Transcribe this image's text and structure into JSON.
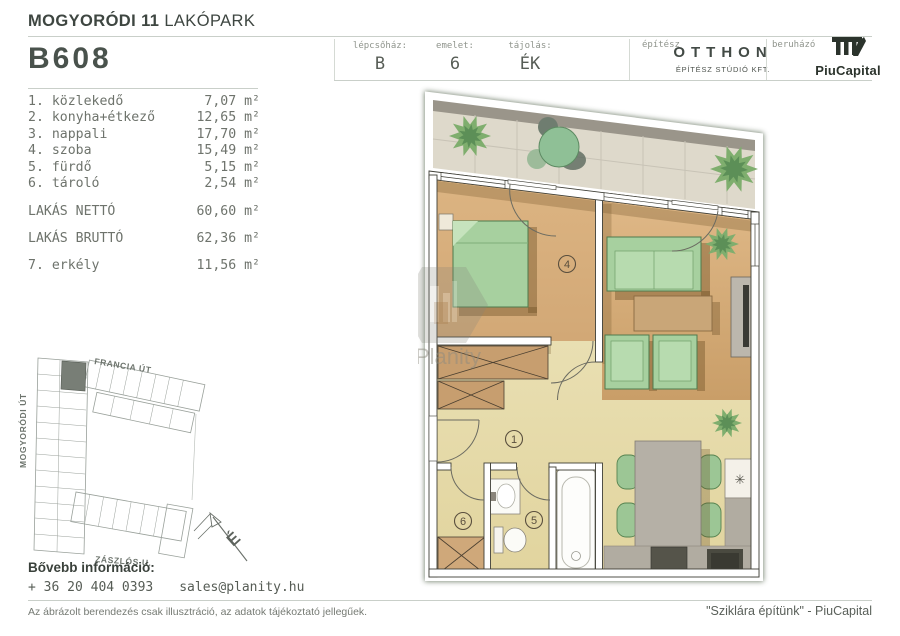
{
  "header": {
    "project_bold": "MOGYORÓDI 11",
    "project_light": " LAKÓPARK",
    "unit_id": "B608",
    "meta": [
      {
        "label": "lépcsőház:",
        "value": "B"
      },
      {
        "label": "emelet:",
        "value": "6"
      },
      {
        "label": "tájolás:",
        "value": "ÉK"
      }
    ],
    "architect": {
      "label": "építész",
      "name": "OTTHON",
      "sub": "ÉPÍTÉSZ STÚDIÓ KFT."
    },
    "developer": {
      "label": "beruházó",
      "name": "PiuCapital"
    }
  },
  "rooms": [
    {
      "name": "1. közlekedő",
      "area": "7,07 m²"
    },
    {
      "name": "2. konyha+étkező",
      "area": "12,65 m²"
    },
    {
      "name": "3. nappali",
      "area": "17,70 m²"
    },
    {
      "name": "4. szoba",
      "area": "15,49 m²"
    },
    {
      "name": "5. fürdő",
      "area": "5,15 m²"
    },
    {
      "name": "6. tároló",
      "area": "2,54 m²"
    }
  ],
  "totals": [
    {
      "name": "LAKÁS NETTÓ",
      "area": "60,60 m²"
    },
    {
      "name": "LAKÁS BRUTTÓ",
      "area": "62,36 m²"
    }
  ],
  "balcony_row": {
    "name": "7. erkély",
    "area": "11,56 m²"
  },
  "site_plan": {
    "street_top": "FRANCIA ÚT",
    "street_left": "MOGYORÓDI ÚT",
    "street_bottom": "ZÁSZLÓS U.",
    "north": "É"
  },
  "floor_plan": {
    "labels": {
      "hall": "1",
      "bedroom": "4",
      "bath": "5",
      "storage": "6"
    },
    "watermark": "Planity",
    "sink_symbol": "✳"
  },
  "footer": {
    "info_label": "Bővebb információ:",
    "phone": "+ 36 20 404 0393",
    "email": "sales@planity.hu",
    "disclaimer": "Az ábrázolt berendezés csak illusztráció, az adatok tájékoztató jellegűek.",
    "slogan": "\"Sziklára építünk\" - PiuCapital"
  },
  "colors": {
    "brand_dark": "#2b332c",
    "wood_floor": "#d9b17c",
    "tile_floor": "#e8ddab",
    "furniture_green": "#a7d09f",
    "highlight_unit": "#787e76"
  }
}
